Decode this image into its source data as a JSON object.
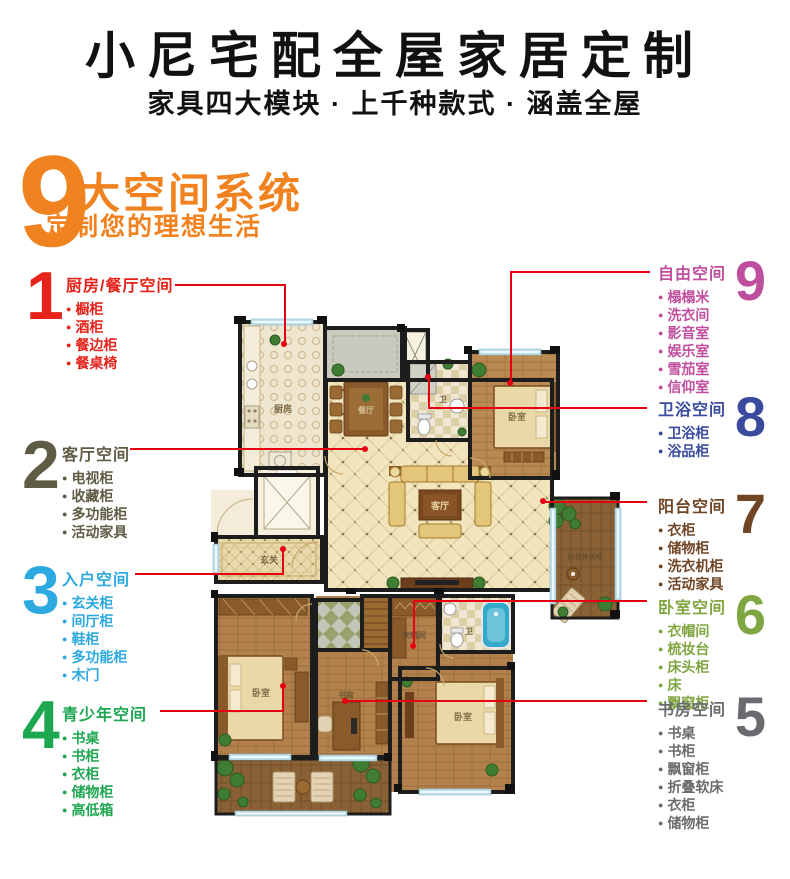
{
  "header": {
    "title": "小尼宅配全屋家居定制",
    "subtitle": "家具四大模块 · 上千种款式 · 涵盖全屋"
  },
  "hero": {
    "number": "9",
    "headline": "大空间系统",
    "subheadline": "定制您的理想生活",
    "accent_color": "#F0831F"
  },
  "panels": {
    "left": [
      {
        "number": "1",
        "color": "#E5231B",
        "title": "厨房/餐厅空间",
        "items": [
          "橱柜",
          "酒柜",
          "餐边柜",
          "餐桌椅"
        ]
      },
      {
        "number": "2",
        "color": "#5F5C45",
        "title": "客厅空间",
        "items": [
          "电视柜",
          "收藏柜",
          "多功能柜",
          "活动家具"
        ]
      },
      {
        "number": "3",
        "color": "#2CA9E1",
        "title": "入户空间",
        "items": [
          "玄关柜",
          "间厅柜",
          "鞋柜",
          "多功能柜",
          "木门"
        ]
      },
      {
        "number": "4",
        "color": "#1EA751",
        "title": "青少年空间",
        "items": [
          "书桌",
          "书柜",
          "衣柜",
          "储物柜",
          "高低箱"
        ]
      }
    ],
    "right": [
      {
        "number": "9",
        "color": "#C04E9E",
        "title": "自由空间",
        "items": [
          "榻榻米",
          "洗衣间",
          "影音室",
          "娱乐室",
          "雪茄室",
          "信仰室"
        ]
      },
      {
        "number": "8",
        "color": "#3A4B9E",
        "title": "卫浴空间",
        "items": [
          "卫浴柜",
          "浴品柜"
        ]
      },
      {
        "number": "7",
        "color": "#6F4526",
        "title": "阳台空间",
        "items": [
          "衣柜",
          "储物柜",
          "洗衣机柜",
          "活动家具"
        ]
      },
      {
        "number": "6",
        "color": "#7FA640",
        "title": "卧室空间",
        "items": [
          "衣帽间",
          "梳妆台",
          "床头柜",
          "床",
          "飘窗柜"
        ]
      },
      {
        "number": "5",
        "color": "#6A6B6E",
        "title": "书房空间",
        "items": [
          "书桌",
          "书柜",
          "飘窗柜",
          "折叠软床",
          "衣柜",
          "储物柜"
        ]
      }
    ]
  },
  "floorplan": {
    "connector_color": "#E60012",
    "labels": {
      "kitchen": "厨房",
      "dining": "餐厅",
      "bath_top": "卫",
      "bedroom_top_right": "卧室",
      "living": "客厅",
      "entry": "玄关",
      "balcony_right": "阳台休闲吧",
      "bedroom_left": "卧室",
      "study": "书房",
      "closet": "衣帽间",
      "bath_lower": "卫",
      "bedroom_bottom": "卧室"
    }
  }
}
